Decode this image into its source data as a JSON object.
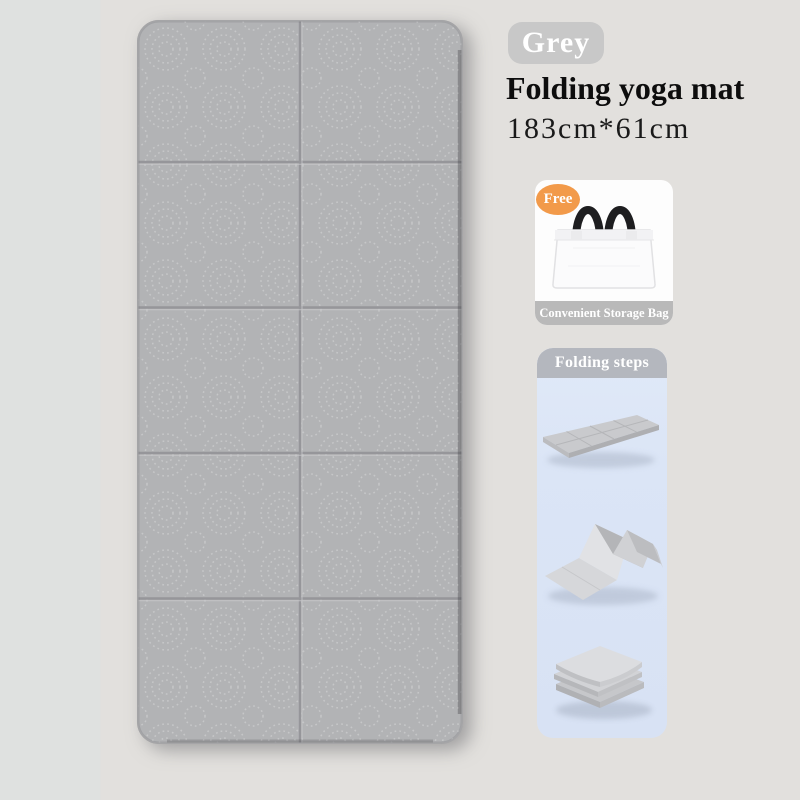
{
  "product": {
    "color_label": "Grey",
    "title": "Folding yoga mat",
    "size": "183cm*61cm"
  },
  "freebie": {
    "badge_label": "Free",
    "caption": "Convenient Storage Bag",
    "icon": "tote-bag-icon"
  },
  "folding_steps": {
    "header": "Folding steps",
    "steps": [
      {
        "icon": "flat-unfolded-mat-icon"
      },
      {
        "icon": "accordion-half-folded-mat-icon"
      },
      {
        "icon": "fully-folded-stack-icon"
      }
    ]
  },
  "mat": {
    "rows": 5,
    "columns": 2,
    "texture": "dotted-swirl"
  },
  "colors": {
    "page_bg": "#e2e0dd",
    "mat": "#b2b3b5",
    "mat_grid": "#97979a",
    "color_badge_bg": "#c8c8c8",
    "accent_orange": "#f29a4a",
    "caption_banner_grey": "#b9b9b9",
    "steps_header_grey": "#b4b7be",
    "steps_panel_blue": "#dbe5f6",
    "text_black": "#0d0d0d",
    "text_white": "#ffffff"
  }
}
